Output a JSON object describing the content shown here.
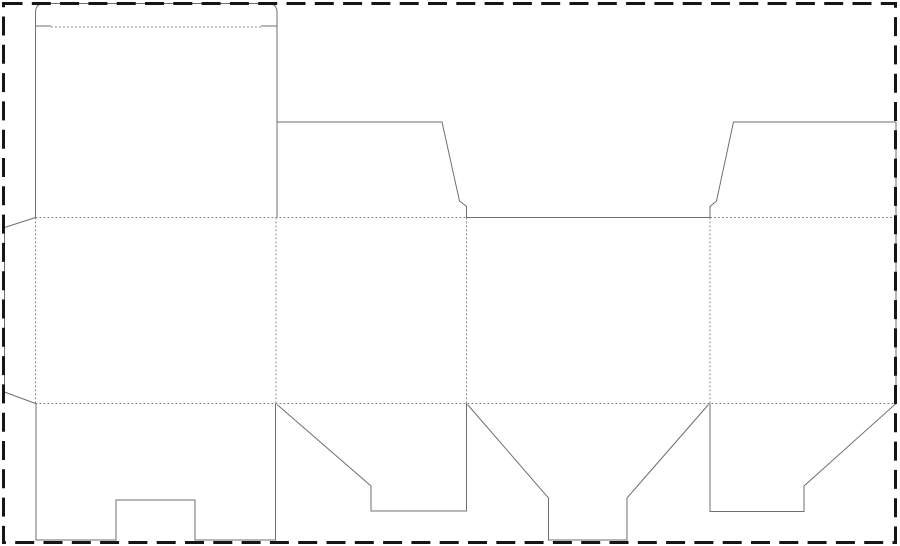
{
  "canvas": {
    "width": 900,
    "height": 546,
    "background": "#ffffff"
  },
  "page_border": {
    "name": "page-border",
    "x": 3.5,
    "y": 3.5,
    "width": 892,
    "height": 539,
    "color": "#161616",
    "stroke_width": 3,
    "dash": "19 9.3"
  },
  "line_styles": {
    "cut": {
      "color": "#6f6f6f",
      "width": 1,
      "dash": ""
    },
    "fold": {
      "color": "#7f7f7f",
      "width": 1,
      "dash": "1.8 2.2"
    }
  },
  "dieline": {
    "cut_paths": [
      {
        "name": "cut-tuck-lid-outline",
        "d": "M 35.5 217.5 L 35.5 12.5 Q 35.5 3.5 44.5 3.5 L 268 3.5 Q 277 3.5 277 12.5 L 277 217.5"
      },
      {
        "name": "cut-tuck-slit-left",
        "d": "M 35.5 26 L 51 26"
      },
      {
        "name": "cut-tuck-slit-right",
        "d": "M 261 26 L 277 26"
      },
      {
        "name": "cut-glue-flap-outline",
        "d": "M 35.5 217.5 L 4.5 227.5 L 4.5 392 L 35.5 403.5"
      },
      {
        "name": "cut-bottom-flap-back",
        "d": "M 36 403.5 L 36 540 L 116 540 L 116 500 L 195 500 L 195 540 L 275.5 540 L 275.5 403.5"
      },
      {
        "name": "cut-bottom-flap-side-left",
        "d": "M 277 404.5 L 371 486 L 371 511 L 466.5 511 L 466.5 403.5"
      },
      {
        "name": "cut-bottom-flap-tongue",
        "d": "M 467.5 404.5 L 548.5 498 L 548.5 540 L 627 540 L 627 498 L 708.5 404.5"
      },
      {
        "name": "cut-bottom-flap-side-right",
        "d": "M 710 403.5 L 710 511.5 L 804 511.5 L 804 486 L 896 403.5"
      },
      {
        "name": "cut-right-edge",
        "d": "M 896 403.5 L 896 122"
      },
      {
        "name": "cut-top-dust-flap-right",
        "d": "M 896 122 L 733.5 122 L 716.5 201 L 710 206.5 L 710 217.5"
      },
      {
        "name": "cut-front-panel-top-edge",
        "d": "M 710 217.5 L 466.5 217.5"
      },
      {
        "name": "cut-top-dust-flap-left",
        "d": "M 466.5 217.5 L 466.5 206.5 L 459.5 201 L 442 122 L 277 122"
      }
    ],
    "fold_paths": [
      {
        "name": "fold-tuck",
        "d": "M 51 27 L 261 27"
      },
      {
        "name": "fold-top-left-section",
        "d": "M 35.5 217.5 L 466.5 217.5"
      },
      {
        "name": "fold-top-right-section",
        "d": "M 710 217.5 L 896 217.5"
      },
      {
        "name": "fold-bottom",
        "d": "M 35.5 403.5 L 896 403.5"
      },
      {
        "name": "fold-vertical-glue",
        "d": "M 35.5 217.5 L 35.5 403.5"
      },
      {
        "name": "fold-vertical-back-side",
        "d": "M 276 217.5 L 276 403.5"
      },
      {
        "name": "fold-vertical-side-front",
        "d": "M 466.5 217.5 L 466.5 403.5"
      },
      {
        "name": "fold-vertical-front-side",
        "d": "M 710 217.5 L 710 403.5"
      }
    ]
  }
}
